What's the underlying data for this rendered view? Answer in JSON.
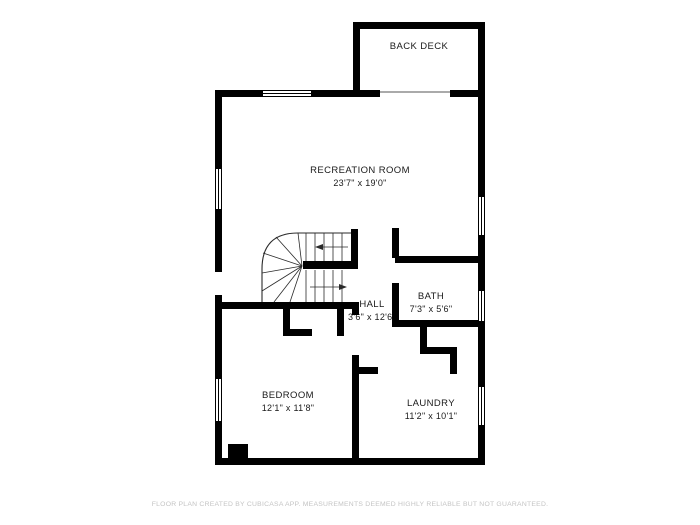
{
  "plan": {
    "rooms": {
      "back_deck": {
        "name": "BACK DECK"
      },
      "recreation": {
        "name": "RECREATION ROOM",
        "dims": "23'7\" x 19'0\""
      },
      "hall": {
        "name": "HALL",
        "dims": "3'6\" x 12'6\""
      },
      "bath": {
        "name": "BATH",
        "dims": "7'3\" x 5'6\""
      },
      "bedroom": {
        "name": "BEDROOM",
        "dims": "12'1\" x 11'8\""
      },
      "laundry": {
        "name": "LAUNDRY",
        "dims": "11'2\" x 10'1\""
      }
    },
    "footer": "FLOOR PLAN CREATED BY CUBICASA APP. MEASUREMENTS DEEMED HIGHLY RELIABLE BUT NOT GUARANTEED."
  }
}
